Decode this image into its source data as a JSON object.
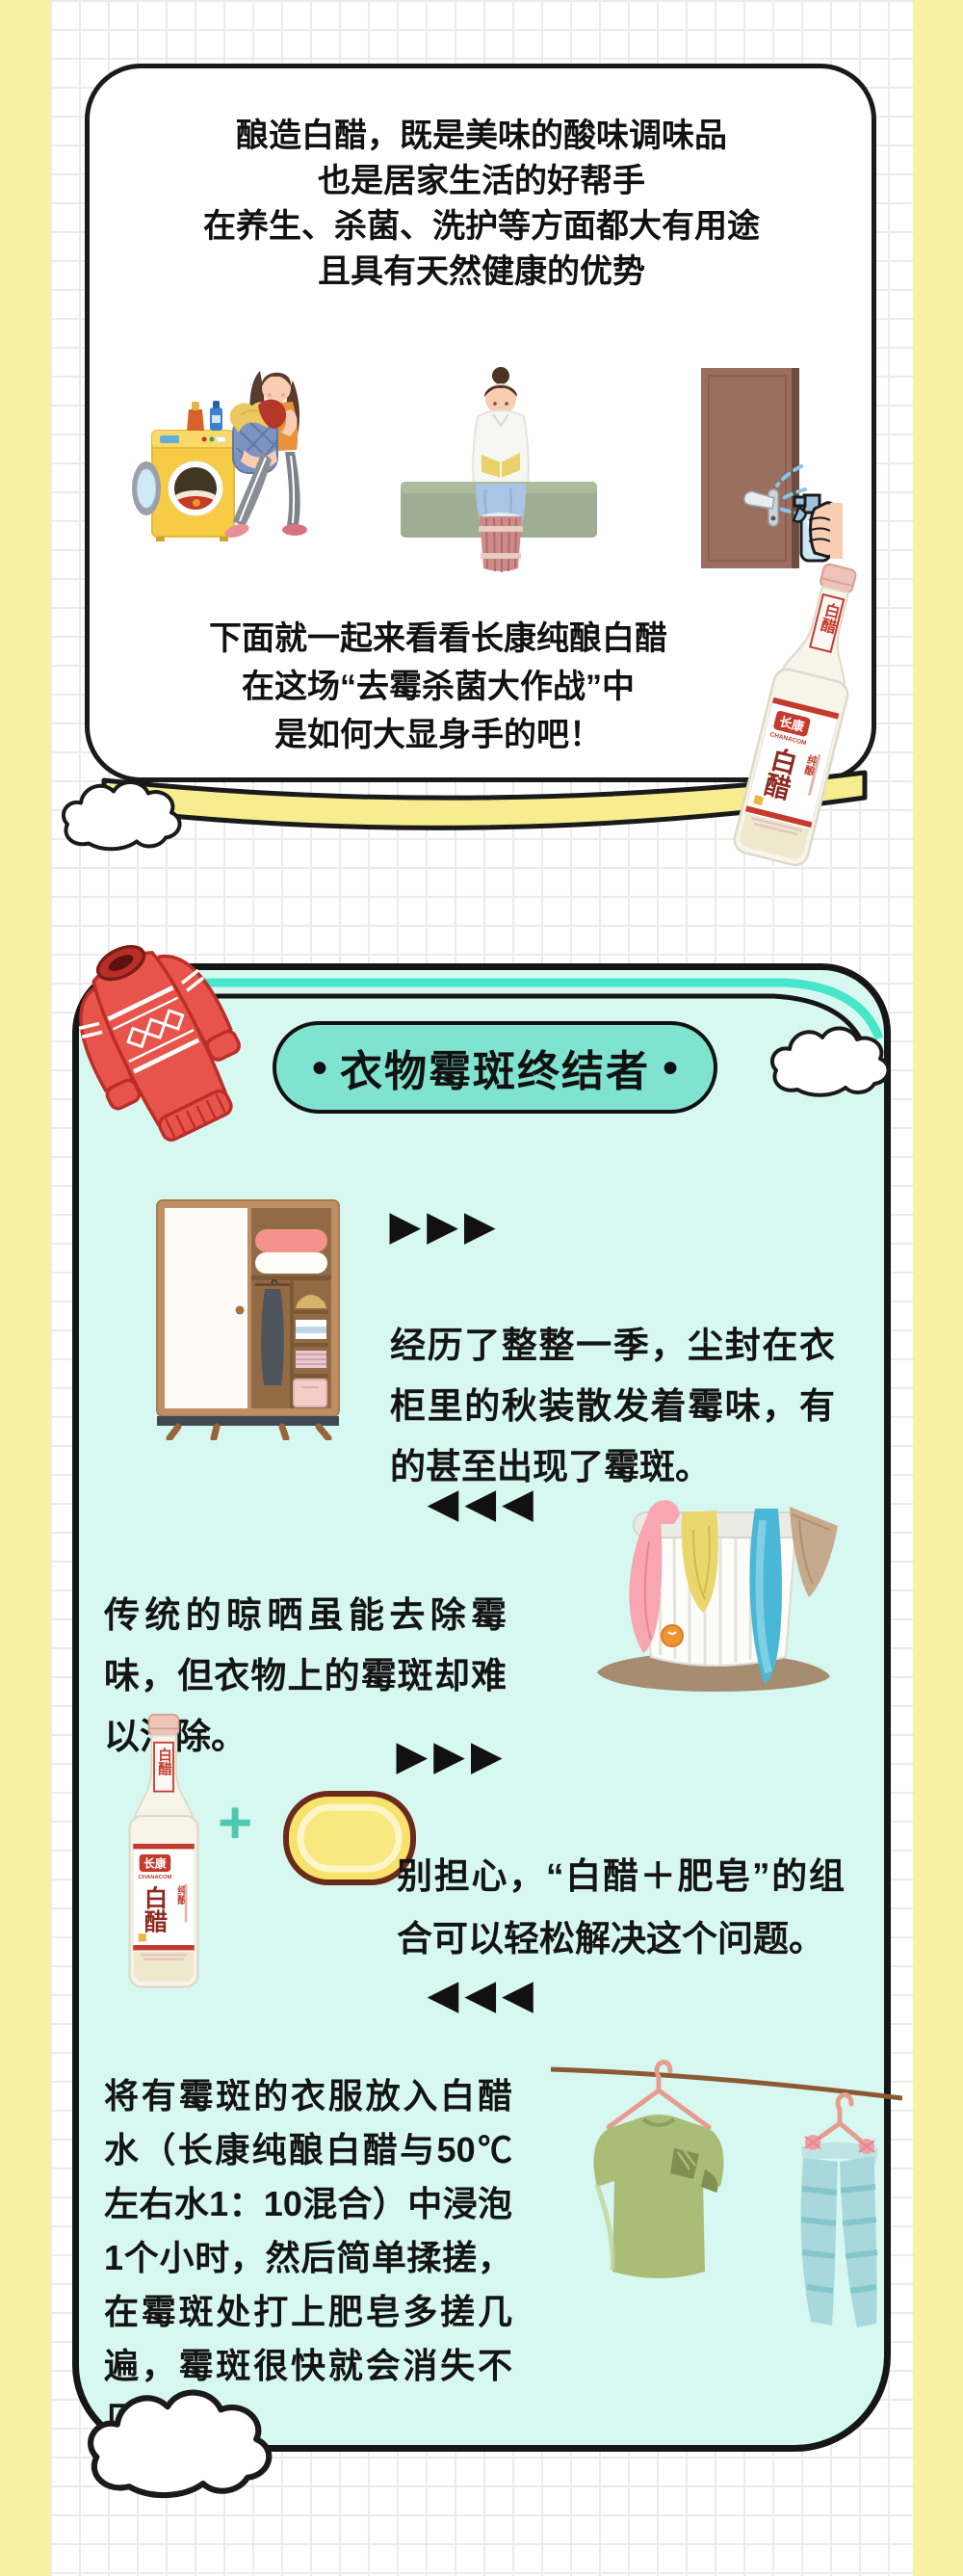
{
  "intro": {
    "lines": [
      "酿造白醋，既是美味的酸味调味品",
      "也是居家生活的好帮手",
      "在养生、杀菌、洗护等方面都大有用途",
      "且具有天然健康的优势"
    ],
    "outro": [
      "下面就一起来看看长康纯酿白醋",
      "在这场“去霉杀菌大作战”中",
      "是如何大显身手的吧！"
    ],
    "illustrations": [
      "laundry-woman-washing-machine",
      "woman-washing-clothes-basin",
      "hand-spraying-door-handle"
    ]
  },
  "product": {
    "brand": "长康",
    "brand_en": "CHANACOM",
    "name": "白醋",
    "type": "纯酿",
    "neck_label": "白醋"
  },
  "section": {
    "title": "衣物霉斑终结者",
    "title_dot": "●",
    "marker_right": "▶▶▶",
    "marker_left": "◀◀◀",
    "para1": "经历了整整一季，尘封在衣柜里的秋装散发着霉味，有的甚至出现了霉斑。",
    "para2": "传统的晾晒虽能去除霉味，但衣物上的霉斑却难以消除。",
    "para3_pre": "别担心，",
    "para3_bold": "“白醋＋肥皂”",
    "para3_post": "的组合可以轻松解决这个问题。",
    "plus_sign": "+",
    "para4_pre": "将有霉斑的衣服放入白醋水",
    "para4_bold": "（长康纯酿白醋与50℃左右水1：10混合）",
    "para4_post": "中浸泡1个小时，然后简单揉搓，在霉斑处打上肥皂多搓几遍，霉斑很快就会消失不见~",
    "illustrations": [
      "wardrobe",
      "laundry-basket-towels",
      "vinegar-bottle-plus-soap",
      "clothes-drying-on-line"
    ]
  },
  "colors": {
    "side_band_yellow": "#f6f1a3",
    "grid_line": "#ebebeb",
    "card_border_black": "#1a1a1a",
    "bottom_band_yellow": "#f7ec8f",
    "mint_card_fill": "#d7f8f1",
    "teal_stripe": "#45e6c9",
    "pill_fill": "#7fe3cf",
    "sweater_red": "#e8544b",
    "soap_yellow": "#f7e26b",
    "plus_teal": "#4cc9b0",
    "label_red": "#c43b2e"
  }
}
